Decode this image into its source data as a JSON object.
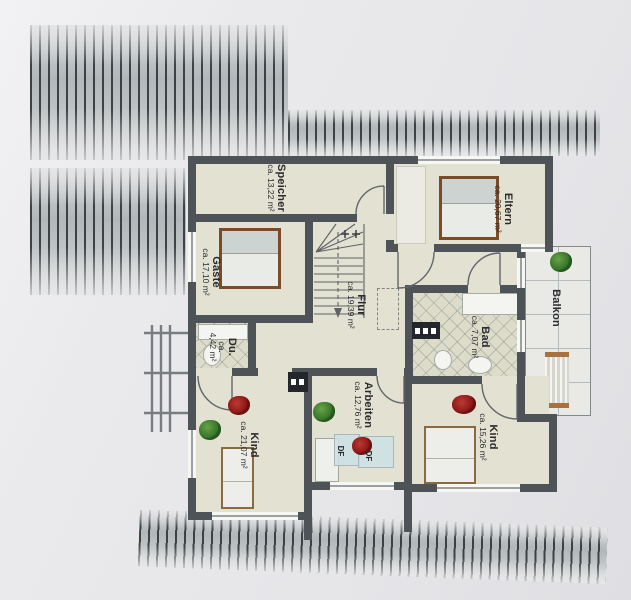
{
  "plan": {
    "rooms": {
      "speicher": {
        "name": "Speicher",
        "area": "ca. 13,22 m²"
      },
      "gaeste": {
        "name": "Gäste",
        "area": "ca. 17,10 m²"
      },
      "eltern": {
        "name": "Eltern",
        "area": "ca. 20,67 m²"
      },
      "flur": {
        "name": "Flur",
        "area": "ca. 19,39 m²"
      },
      "bad": {
        "name": "Bad",
        "area": "ca. 7,07 m²"
      },
      "dusche": {
        "name": "Du.",
        "area": "ca. 4,42 m²"
      },
      "kind_links": {
        "name": "Kind",
        "area": "ca. 21,07 m²"
      },
      "arbeiten": {
        "name": "Arbeiten",
        "area": "ca. 12,76 m²"
      },
      "kind_rechts": {
        "name": "Kind",
        "area": "ca. 15,26 m²"
      },
      "balkon": {
        "name": "Balkon",
        "area": ""
      }
    },
    "skylights": {
      "left": "DF",
      "right": "DF"
    },
    "colors": {
      "wall": "#4d5357",
      "floor": "#e2e1d2",
      "roof_stripes": "#394044",
      "paper": "#e8e8ea",
      "plant_green": "#3f7d2b",
      "plant_red": "#8f1d1d",
      "bed_frame": "#7a4b26",
      "skylight_blue": "#cfe0e3"
    }
  }
}
